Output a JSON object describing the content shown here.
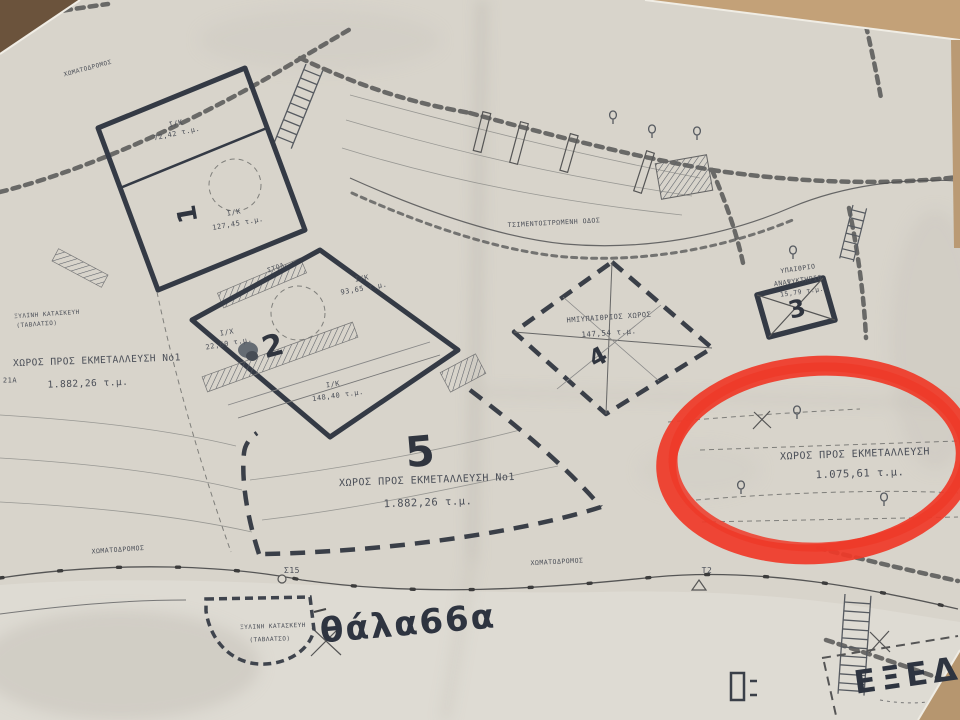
{
  "map": {
    "roads": {
      "dirt_top": "ΧΩΜΑΤΟΔΡΟΜΟΣ",
      "dirt_bottom_left": "ΧΩΜΑΤΟΔΡΟΜΟΣ",
      "dirt_bottom_mid": "ΧΩΜΑΤΟΔΡΟΜΟΣ",
      "paved": "ΤΣΙΜΕΝΤΟΣΤΡΩΜΕΝΗ ΟΔΟΣ"
    },
    "area1": {
      "number": "1",
      "code_top": "Ι/Κ",
      "area_top": "72,42 τ.μ.",
      "code_main": "Ι/Κ",
      "area_main": "127,45 τ.μ."
    },
    "stoa_label": "ΣΤΟΑ",
    "area2": {
      "number": "2",
      "code_a": "Ι/Κ",
      "area_a": "93,65 τ.μ.",
      "code_b": "Ι/Χ",
      "area_b": "22,60 τ.μ.",
      "code_c": "Ι/Κ",
      "area_c": "148,40 τ.μ."
    },
    "area3": {
      "number": "3",
      "line1": "ΥΠΑΙΘΡΙΟ",
      "line2": "ΑΝΑΨΥΚΤΗΡΙΟ",
      "area": "15,79 τ.μ."
    },
    "area4": {
      "number": "4",
      "label": "ΗΜΙΥΠΑΙΘΡΙΟΣ ΧΩΡΟΣ",
      "area": "147,54 τ.μ."
    },
    "area5": {
      "number": "5",
      "label": "ΧΩΡΟΣ ΠΡΟΣ ΕΚΜΕΤΑΛΛΕΥΣΗ Νο1",
      "area": "1.882,26 τ.μ."
    },
    "west_plot": {
      "label": "ΧΩΡΟΣ ΠΡΟΣ ΕΚΜΕΤΑΛΛΕΥΣΗ Νο1",
      "area": "1.882,26 τ.μ.",
      "point": "21Α"
    },
    "circled_plot": {
      "label": "ΧΩΡΟΣ ΠΡΟΣ ΕΚΜΕΤΑΛΛΕΥΣΗ",
      "area": "1.075,61 τ.μ."
    },
    "wooden_west": {
      "line1": "ΞΥΛΙΝΗ ΚΑΤΑΣΚΕΥΗ",
      "line2": "(ΤΑΒΛΑΤΣΟ)"
    },
    "wooden_south": {
      "line1": "ΞΥΛΙΝΗ ΚΑΤΑΣΚΕΥΗ",
      "line2": "(ΤΑΒΛΑΤΣΟ)"
    },
    "markers": {
      "s15": "Σ15",
      "t2": "Τ2"
    },
    "handwriting": {
      "sea": "θάλα66α",
      "exedra": "ΕΞΕΔΡΑ"
    },
    "colors": {
      "annotation_red": "#ef3a29",
      "paper": "#d8d4cb",
      "ink": "#3a3f49"
    }
  }
}
